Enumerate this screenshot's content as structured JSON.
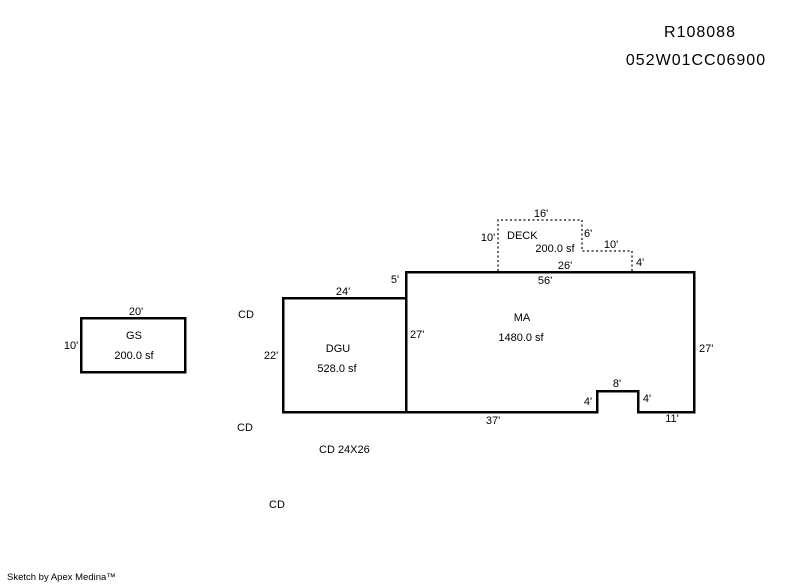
{
  "header": {
    "record_id": "R108088",
    "parcel_id": "052W01CC06900"
  },
  "footer": {
    "credit": "Sketch by Apex Medina™"
  },
  "structures": {
    "gs": {
      "label": "GS",
      "area": "200.0 sf",
      "dim_top": "20'",
      "dim_left": "10'"
    },
    "dgu": {
      "label": "DGU",
      "area": "528.0 sf",
      "dim_top": "24'",
      "dim_left": "22'"
    },
    "ma": {
      "label": "MA",
      "area": "1480.0 sf",
      "dim_top": "56'",
      "dim_left_upper": "5'",
      "dim_left_inner": "27'",
      "dim_right": "27'",
      "dim_bottom_left": "37'",
      "dim_notch_left": "4'",
      "dim_notch_top": "8'",
      "dim_notch_right": "4'",
      "dim_bottom_right": "11'"
    },
    "deck": {
      "label": "DECK",
      "area": "200.0 sf",
      "dim_top": "16'",
      "dim_left": "10'",
      "dim_right": "6'",
      "dim_step_top": "10'",
      "dim_step_right": "4'",
      "dim_bottom": "26'"
    }
  },
  "annotations": {
    "cd_upper": "CD",
    "cd_lower": "CD",
    "cd_size": "CD 24X26",
    "cd_bottom": "CD"
  },
  "colors": {
    "line": "#000000",
    "background": "#ffffff"
  }
}
